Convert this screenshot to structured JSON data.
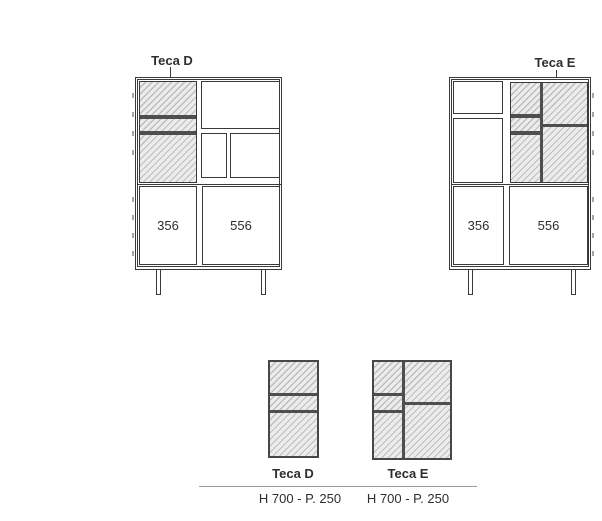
{
  "colors": {
    "line": "#3a3a3a",
    "divider": "#4e4e4e",
    "hatch_background": "#ececec",
    "hatch_line": "#bdbdbd",
    "text": "#2e2e2e",
    "rule": "#9c9c9c",
    "hinge_tick": "#a5a5a5"
  },
  "front_views": {
    "teca_d": {
      "label": "Teca D",
      "left_door_width": "356",
      "right_door_width": "556"
    },
    "teca_e": {
      "label": "Teca E",
      "left_door_width": "356",
      "right_door_width": "556"
    }
  },
  "legend": {
    "items": [
      {
        "name": "Teca D",
        "dimensions": "H 700 - P. 250"
      },
      {
        "name": "Teca E",
        "dimensions": "H 700 - P. 250"
      }
    ]
  }
}
